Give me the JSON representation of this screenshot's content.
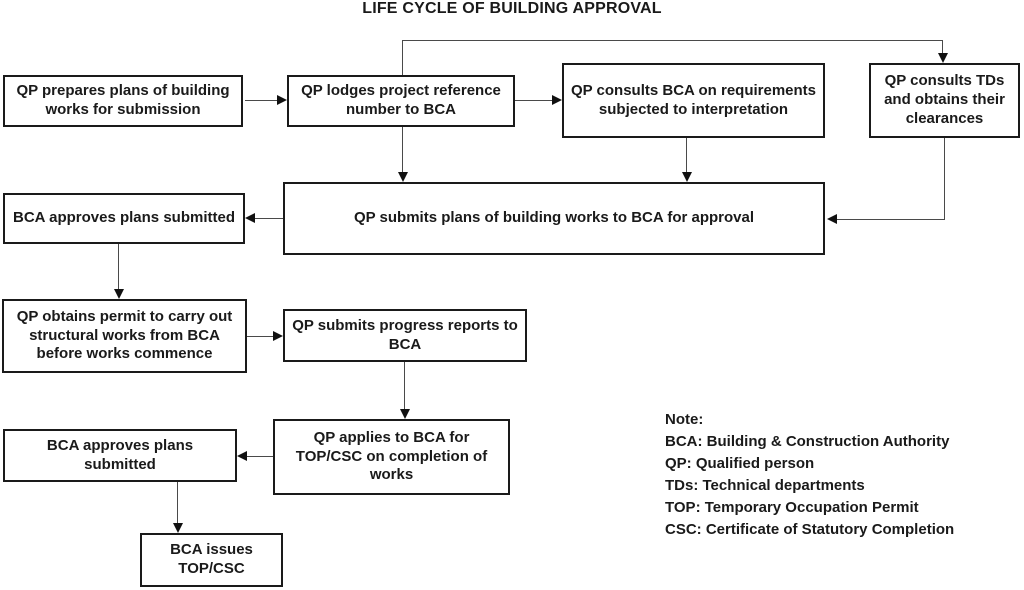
{
  "title": "LIFE CYCLE OF BUILDING APPROVAL",
  "colors": {
    "background": "#ffffff",
    "box_border": "#1a1a1a",
    "connector_line": "#4a4a4a",
    "arrowhead": "#111111",
    "text": "#1a1a1a"
  },
  "nodes": [
    {
      "id": "prepare-plans",
      "label": "QP prepares plans of building works for submission"
    },
    {
      "id": "lodge-reference",
      "label": "QP lodges project reference number to BCA"
    },
    {
      "id": "consult-bca",
      "label": "QP consults BCA on requirements subjected to interpretation"
    },
    {
      "id": "consult-tds",
      "label": "QP consults TDs and obtains their clearances"
    },
    {
      "id": "submit-plans",
      "label": "QP submits plans of building works to BCA for approval"
    },
    {
      "id": "bca-approves-1",
      "label": "BCA approves plans submitted"
    },
    {
      "id": "obtain-permit",
      "label": "QP obtains permit to carry out structural works from BCA before works commence"
    },
    {
      "id": "progress-reports",
      "label": "QP submits progress reports to BCA"
    },
    {
      "id": "apply-top-csc",
      "label": "QP applies to BCA for TOP/CSC on completion of works"
    },
    {
      "id": "bca-approves-2",
      "label": "BCA approves plans submitted"
    },
    {
      "id": "issue-top-csc",
      "label": "BCA issues TOP/CSC"
    }
  ],
  "note": {
    "heading": "Note:",
    "lines": [
      "BCA: Building & Construction Authority",
      "QP: Qualified person",
      "TDs: Technical departments",
      "TOP: Temporary Occupation Permit",
      "CSC: Certificate of Statutory Completion"
    ]
  }
}
